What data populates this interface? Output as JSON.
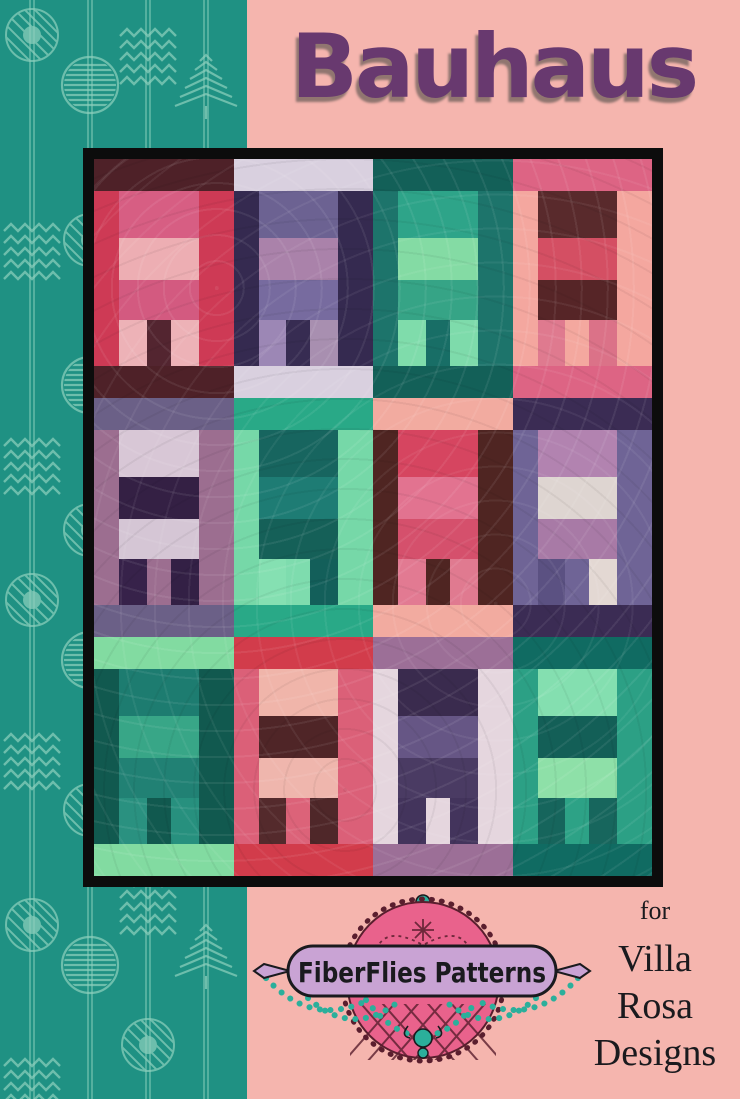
{
  "title": "Bauhaus",
  "logo": {
    "brand": "FiberFlies Patterns"
  },
  "attribution": {
    "pre": "for",
    "lines": {
      "0": "Villa",
      "1": "Rosa",
      "2": "Designs"
    }
  },
  "colors": {
    "teal": "#1F9183",
    "tealLight": "#8FD1BE",
    "pink": "#F5B5AE",
    "titlePurple": "#68396F",
    "frame": "#0C0C0C",
    "logoPink": "#E9628C",
    "logoPinkDark": "#5A1E2E",
    "logoLavender": "#C9A3D4",
    "beadTeal": "#2BAF9B",
    "ink": "#1A1A1E"
  },
  "sidebar": {
    "motifs": [
      "striped-circle",
      "diagonal-circle-dot",
      "chevron-arrows",
      "striped-tree"
    ]
  },
  "quilt": {
    "rows": 3,
    "cols": 4,
    "blocks": [
      {
        "strip": "#4E2128",
        "bg": "#CE3A55",
        "bands": [
          "#D75E83",
          "#EDAEB3",
          "#D35A80"
        ],
        "legs": [
          "#EDB2B7",
          "#532530",
          "#EDB2B7"
        ]
      },
      {
        "strip": "#D9D0DF",
        "bg": "#352A50",
        "bands": [
          "#6C6292",
          "#AA82AA",
          "#776B9F"
        ],
        "legs": [
          "#9C87B5",
          "#372C52",
          "#A88FB0"
        ]
      },
      {
        "strip": "#136058",
        "bg": "#1D746B",
        "bands": [
          "#2EA489",
          "#84DBA4",
          "#36A486"
        ],
        "legs": [
          "#7FDCAB",
          "#186E66",
          "#7EDBAB"
        ]
      },
      {
        "strip": "#DD6484",
        "bg": "#F4A79F",
        "bands": [
          "#592A2C",
          "#D44F63",
          "#562527"
        ],
        "legs": [
          "#DF7A8F",
          "#F4A89F",
          "#DB7288"
        ]
      },
      {
        "strip": "#6B6087",
        "bg": "#9C6E90",
        "bands": [
          "#D8C7D6",
          "#342044",
          "#D5C6D5"
        ],
        "legs": [
          "#37224A",
          "#9C6E90",
          "#332045"
        ]
      },
      {
        "strip": "#29A987",
        "bg": "#76D8A8",
        "bands": [
          "#17655F",
          "#1E7C74",
          "#156058"
        ],
        "legs": [
          "#85E0B2",
          "#7EDCAE",
          "#135F5A"
        ]
      },
      {
        "strip": "#F2ABA0",
        "bg": "#4F2522",
        "bands": [
          "#D64560",
          "#E27390",
          "#D5506C"
        ],
        "legs": [
          "#E27A92",
          "#4F2522",
          "#E07A90"
        ]
      },
      {
        "strip": "#3B2C54",
        "bg": "#6F6496",
        "bands": [
          "#B283B0",
          "#DED5D1",
          "#A87AA6"
        ],
        "legs": [
          "#5B5182",
          "#6F6496",
          "#E3D8D3"
        ]
      },
      {
        "strip": "#82DBA1",
        "bg": "#11594F",
        "bands": [
          "#1D7C70",
          "#38A687",
          "#218174"
        ],
        "legs": [
          "#2A9180",
          "#11594F",
          "#27907E"
        ]
      },
      {
        "strip": "#D23C4B",
        "bg": "#DB6078",
        "bands": [
          "#F0B5AA",
          "#4F2527",
          "#EFB6AD"
        ],
        "legs": [
          "#542A2C",
          "#DC6379",
          "#4F2729"
        ]
      },
      {
        "strip": "#9C6F97",
        "bg": "#E5D6DE",
        "bands": [
          "#3A2B4E",
          "#665685",
          "#4A3B63"
        ],
        "legs": [
          "#43345C",
          "#E5D6DE",
          "#43345C"
        ]
      },
      {
        "strip": "#106B62",
        "bg": "#2CA085",
        "bands": [
          "#84DFB0",
          "#135F57",
          "#8EE0A8"
        ],
        "legs": [
          "#16655C",
          "#2DA286",
          "#17665D"
        ]
      }
    ]
  }
}
